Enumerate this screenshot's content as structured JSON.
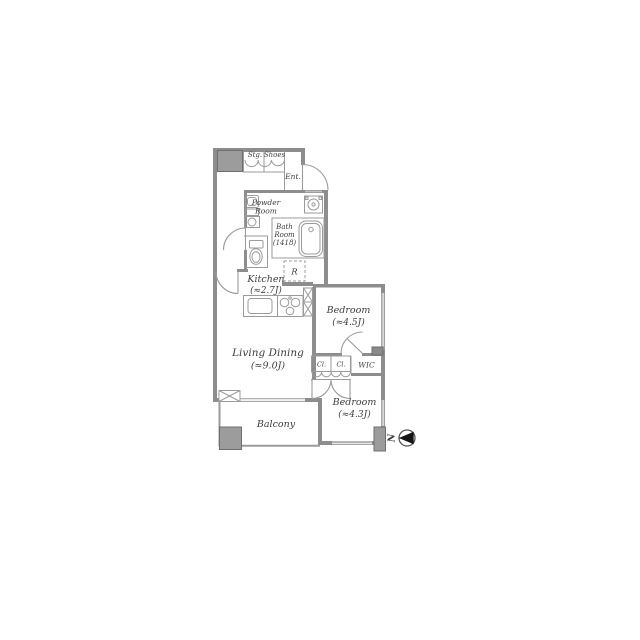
{
  "plan": {
    "title": "apartment-floor-plan",
    "labels": {
      "storage": "Stg.",
      "shoes": "Shoes",
      "entrance": "Ent.",
      "powder_line1": "Powder",
      "powder_line2": "Room",
      "bath_line1": "Bath",
      "bath_line2": "Room",
      "bath_size": "(1418)",
      "kitchen_name": "Kitchen",
      "kitchen_size": "(≈2.7J)",
      "refrigerator": "R",
      "bedroom_upper_name": "Bedroom",
      "bedroom_upper_size": "(≈4.5J)",
      "living_name": "Living Dining",
      "living_size": "(≈9.0J)",
      "closet_1": "Cl.",
      "closet_2": "Cl.",
      "wic": "WIC",
      "bedroom_lower_name": "Bedroom",
      "bedroom_lower_size": "(≈4.3J)",
      "balcony": "Balcony",
      "compass_north": "N"
    },
    "colors": {
      "wall": "#8d8d8d",
      "line": "#9b9b9b",
      "text": "#3d3d3d",
      "pillar": "#9c9c9c",
      "pillar_border": "#6f6f6f",
      "compass_arrow": "#151515"
    }
  }
}
